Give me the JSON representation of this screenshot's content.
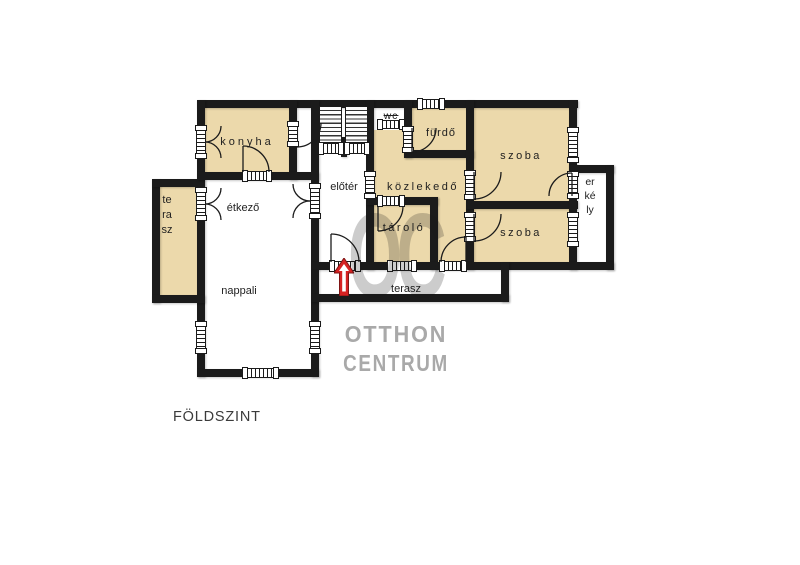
{
  "page": {
    "background": "#ffffff"
  },
  "floor_plan": {
    "floor_label": "FÖLDSZINT",
    "rooms": {
      "konyha": "konyha",
      "etkezo": "étkező",
      "nappali": "nappali",
      "terasz_left": "terasz",
      "eloter": "előtér",
      "wc": "wc",
      "furdo": "fürdő",
      "kozlekedo": "közlekedő",
      "tarolo": "tároló",
      "szoba_felso": "szoba",
      "szoba_also": "szoba",
      "terasz_also": "terasz",
      "erkely": "erkély"
    },
    "entrance_arrow": {
      "direction": "up",
      "color": "#d62222"
    },
    "colors": {
      "room_fill": "#ecd9ab",
      "wall": "#1b1b1b",
      "window_fill": "#ffffff"
    }
  },
  "watermark": {
    "monogram": "OC",
    "line1": "OTTHON",
    "line2": "CENTRUM",
    "color": "#a9a9a9"
  }
}
